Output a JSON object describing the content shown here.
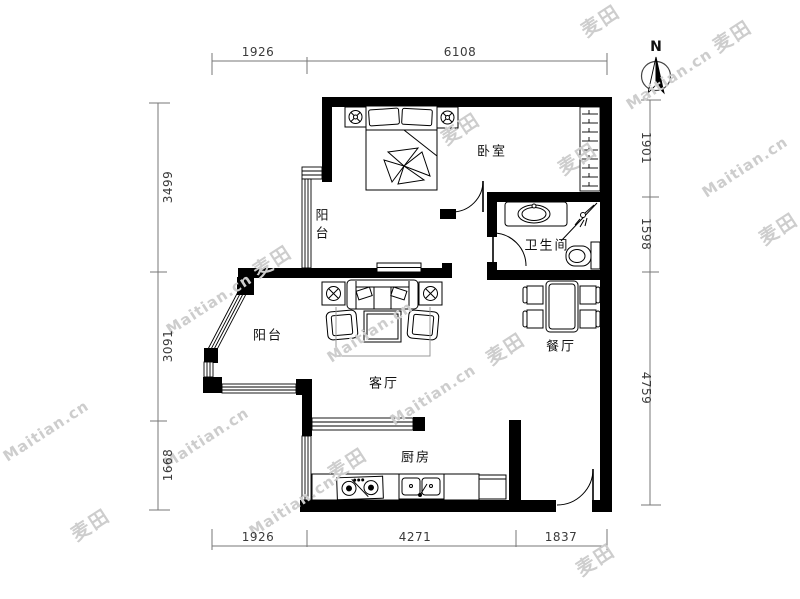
{
  "compass": {
    "north_label": "N"
  },
  "rooms": {
    "bedroom": "卧室",
    "balcony_north": "阳台",
    "bathroom": "卫生间",
    "balcony_west": "阳台",
    "living": "客厅",
    "dining": "餐厅",
    "kitchen": "厨房"
  },
  "dimensions": {
    "top": [
      "1926",
      "6108"
    ],
    "bottom": [
      "1926",
      "4271",
      "1837"
    ],
    "left": [
      "3499",
      "3091",
      "1668"
    ],
    "right": [
      "1901",
      "1598",
      "4759"
    ]
  },
  "watermark": {
    "brand": "Maitian.cn",
    "logo": "麦田"
  },
  "colors": {
    "wall": "#000000",
    "dimension_line": "#777777",
    "label_text": "#111111",
    "watermark": "#cdcdcd"
  }
}
